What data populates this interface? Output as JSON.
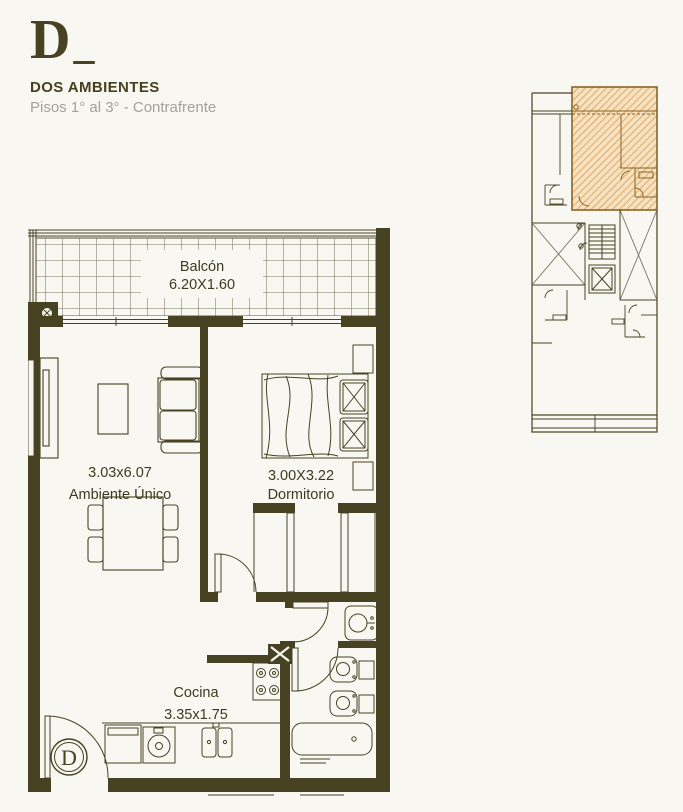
{
  "header": {
    "unit_letter": "D",
    "underscore": "_",
    "type_label": "DOS AMBIENTES",
    "floors_label": "Pisos 1° al 3° - Contrafrente"
  },
  "floor_plan": {
    "balcony": {
      "name": "Balcón",
      "dims": "6.20X1.60"
    },
    "living": {
      "dims": "3.03x6.07",
      "name": "Ambiente Único"
    },
    "bedroom": {
      "dims": "3.00X3.22",
      "name": "Dormitorio"
    },
    "kitchen": {
      "name": "Cocina",
      "dims": "3.35x1.75"
    },
    "entrance_unit_letter": "D"
  },
  "colors": {
    "background": "#f8f7f1",
    "wall": "#474322",
    "text_dark": "#3e3a20",
    "subtitle_gray": "#a3a29a",
    "hatch_fill": "#f6e2c0",
    "hatch_line": "#d89b52",
    "hatch_outline": "#8a6425"
  }
}
